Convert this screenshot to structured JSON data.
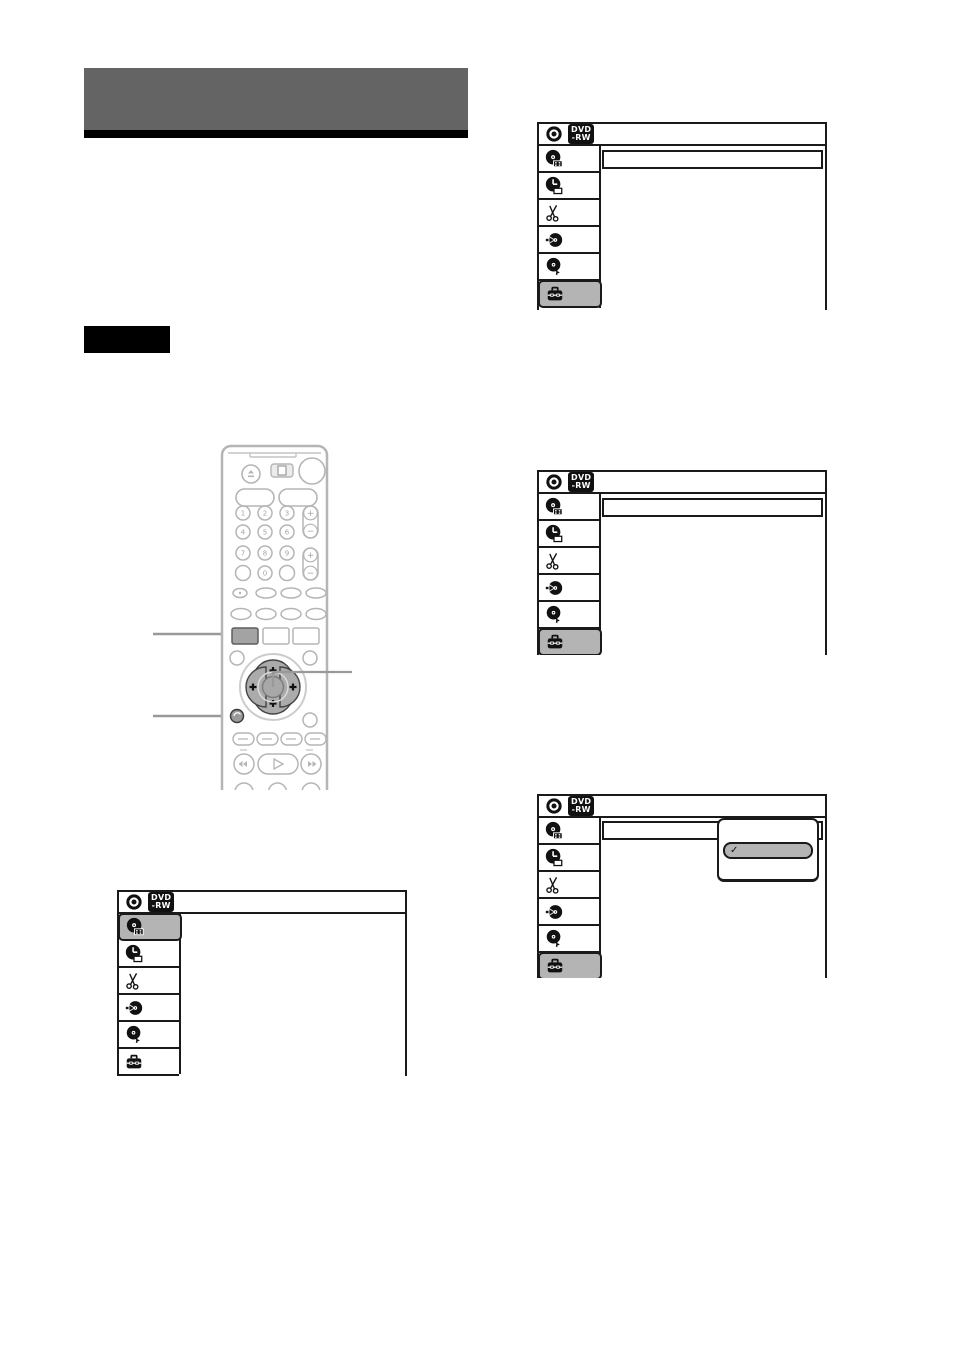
{
  "page": {
    "background": "#ffffff"
  },
  "title_block": {
    "bar_color": "#646464",
    "rule_color": "#000000"
  },
  "note_box": {
    "color": "#000000"
  },
  "osd": {
    "badge": {
      "line1": "DVD",
      "line2": "-RW"
    },
    "sidebar_icons": [
      "title-list",
      "timer",
      "edit",
      "dubbing",
      "disc-setting",
      "tools"
    ],
    "screens": [
      {
        "id": "bottom-left",
        "selected": "title-list",
        "option_box": false
      },
      {
        "id": "top-right",
        "selected": "tools",
        "option_box": true
      },
      {
        "id": "middle-right",
        "selected": "tools",
        "option_box": true
      },
      {
        "id": "bottom-right",
        "selected": "tools",
        "option_box": true,
        "popup": {
          "checkmark": "✓"
        }
      }
    ]
  },
  "remote": {
    "keypad": [
      "1",
      "2",
      "3",
      "4",
      "5",
      "6",
      "7",
      "8",
      "9",
      "0"
    ],
    "volume_plus": "+",
    "volume_minus": "−",
    "channel_plus": "+",
    "channel_minus": "−"
  },
  "colors": {
    "menu_border": "#1a1a1a",
    "highlight_gray": "#b4b4b4",
    "tools_button_gray": "#a3a3a3",
    "callout_line": "#999999",
    "remote_outline": "#b5b5b5"
  }
}
